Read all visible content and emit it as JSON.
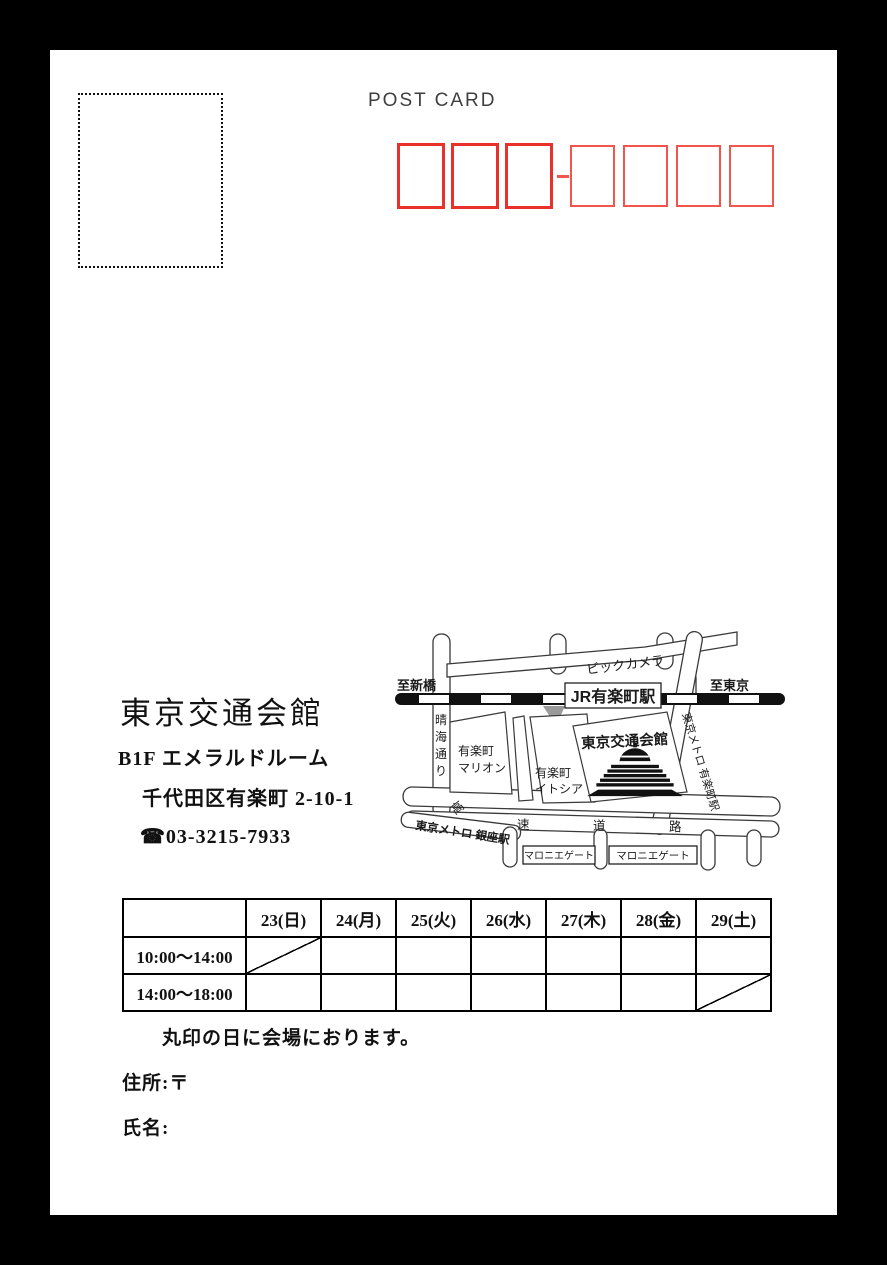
{
  "colors": {
    "page_bg": "#000000",
    "card_bg": "#ffffff",
    "postal_major_red": "#e8312b",
    "postal_minor_red": "#f0564e",
    "postcard_text": "#3f3f3f"
  },
  "postcard": {
    "title": "POST CARD"
  },
  "venue": {
    "name": "東京交通会館",
    "room": "B1F  エメラルドルーム",
    "address": "千代田区有楽町 2-10-1",
    "phone": "☎03-3215-7933"
  },
  "map": {
    "labels": {
      "to_shimbashi": "至新橋",
      "to_tokyo": "至東京",
      "jr_station": "JR有楽町駅",
      "bic_camera": "ビックカメラ",
      "harumi_dori": [
        "晴",
        "海",
        "通",
        "り"
      ],
      "marion_line1": "有楽町",
      "marion_line2": "マリオン",
      "itocia_line1": "有楽町",
      "itocia_line2": "イトシア",
      "venue_building": "東京交通会館",
      "metro_yurakucho": "東京メトロ 有楽町駅",
      "metro_ginza": "東京メトロ 銀座駅",
      "expressway": [
        "高",
        "速",
        "道",
        "路"
      ],
      "marronnier_gate_1": "マロニエゲート",
      "marronnier_gate_2": "マロニエゲート"
    }
  },
  "schedule": {
    "headers": [
      "",
      "23(日)",
      "24(月)",
      "25(火)",
      "26(水)",
      "27(木)",
      "28(金)",
      "29(土)"
    ],
    "rows": [
      {
        "time": "10:00〜14:00",
        "slash_col": 1
      },
      {
        "time": "14:00〜18:00",
        "slash_col": 7
      }
    ],
    "note": "丸印の日に会場におります。"
  },
  "form": {
    "address_label": "住所:〒",
    "name_label": "氏名:"
  }
}
